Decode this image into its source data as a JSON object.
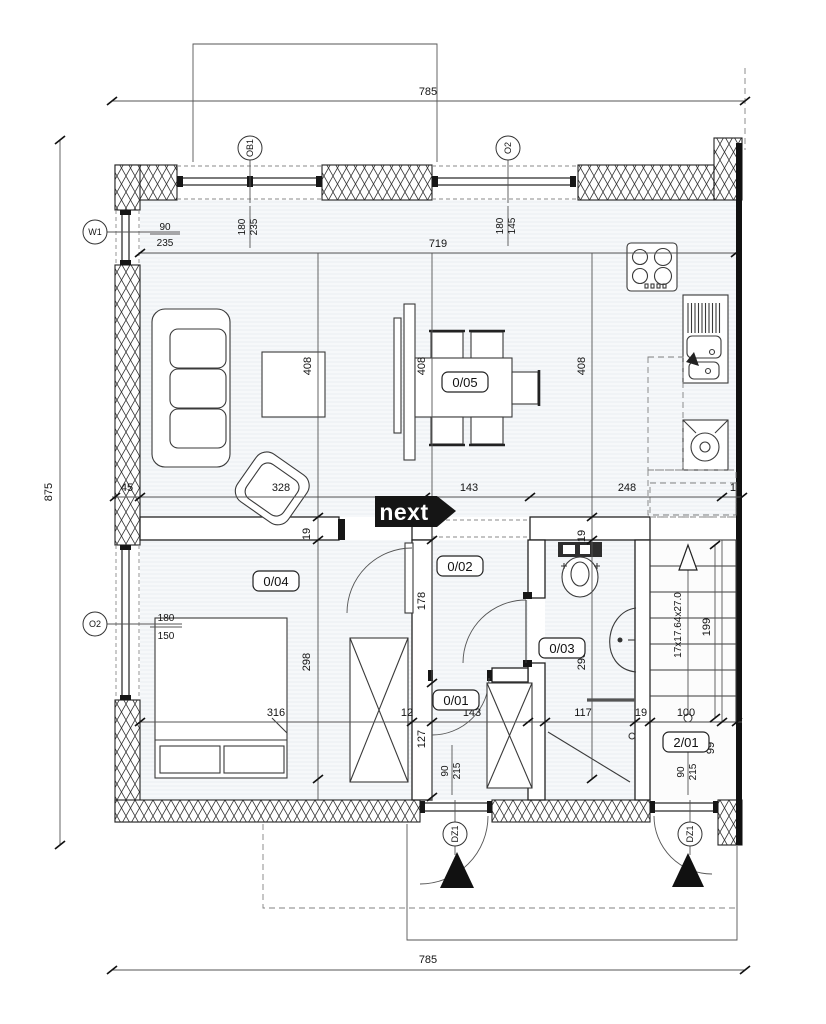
{
  "plan": {
    "logo": "next",
    "rooms": {
      "living": "0/05",
      "bedroom": "0/04",
      "corridor": "0/02",
      "bathroom": "0/03",
      "hall": "0/01",
      "stairs": "2/01"
    },
    "openings": {
      "ob1": {
        "label": "OB1",
        "w": "180",
        "h": "235"
      },
      "o2_top": {
        "label": "O2",
        "w": "180",
        "h": "145"
      },
      "w1": {
        "label": "W1",
        "w": "90",
        "h": "235"
      },
      "o2_left": {
        "label": "O2",
        "w": "180",
        "h": "150"
      },
      "dz1_main": {
        "label": "DZ1",
        "w": "90",
        "h": "215"
      },
      "dz1_stairs": {
        "label": "DZ1",
        "w": "90",
        "h": "215"
      }
    },
    "dims": {
      "top": "785",
      "bottom": "785",
      "left": "875",
      "interior_width": "719",
      "depths": [
        "408",
        "408",
        "408"
      ],
      "mid_chain": [
        "45",
        "328",
        "143",
        "248",
        "19"
      ],
      "wall_a": "19",
      "wall_b": "19",
      "corridor_depth": "178",
      "bedroom_depth": "298",
      "bath_depth": "298",
      "hall_depth": "127",
      "bottom_chain": [
        "316",
        "12",
        "143",
        "117",
        "19",
        "100"
      ],
      "stairs_run": "199",
      "stairs_formula": "17x17.64x27.0",
      "stairs_side": "99"
    }
  }
}
